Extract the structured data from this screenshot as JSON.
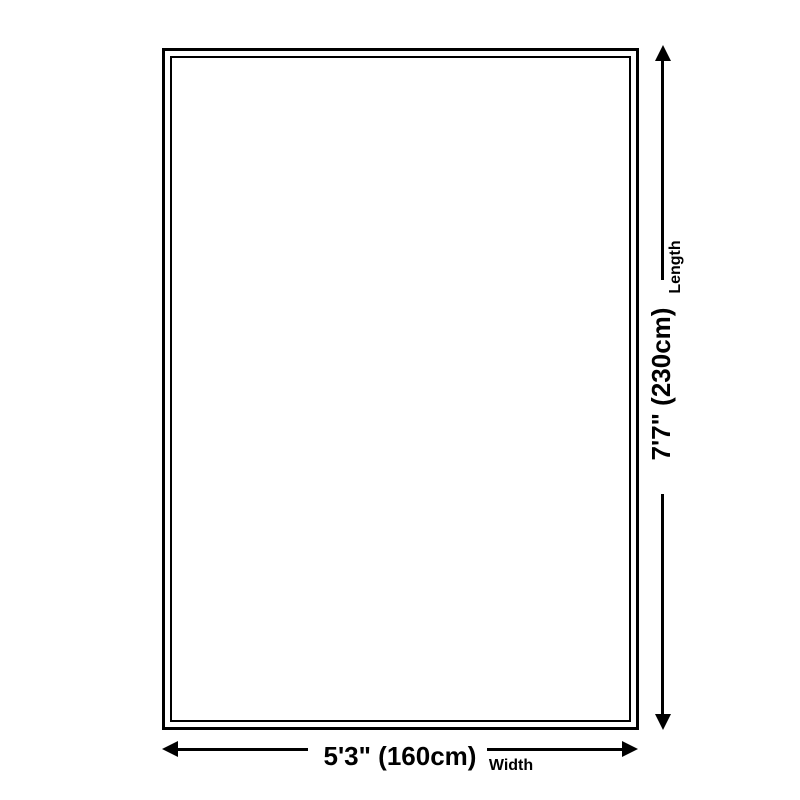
{
  "page": {
    "background": "#ffffff"
  },
  "diagram": {
    "type": "rug-size-diagram",
    "line_color": "#000000",
    "length": {
      "label": "Length",
      "value": "7'7\" (230cm)"
    },
    "width": {
      "label": "Width",
      "value": "5'3\" (160cm)"
    }
  }
}
